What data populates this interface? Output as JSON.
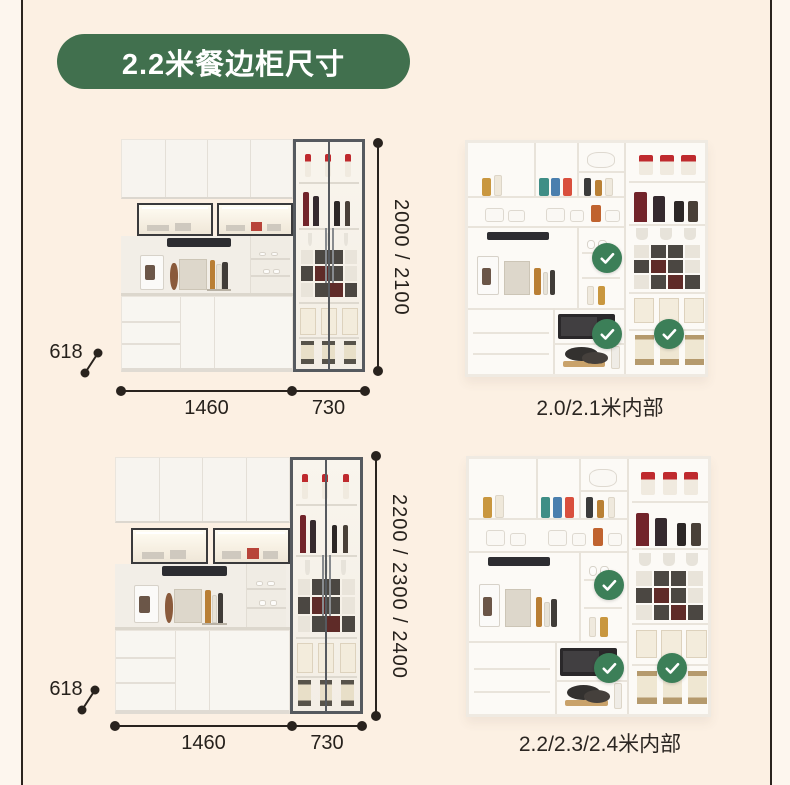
{
  "badge": {
    "label": "2.2米餐边柜尺寸"
  },
  "colors": {
    "accent_green": "#41704e",
    "check_green": "#3c7f58",
    "page_background": "#fcf0e3",
    "line_color": "#29231e"
  },
  "figures": {
    "top": {
      "height_label": "2000 / 2100",
      "depth_label": "618",
      "width_left_label": "1460",
      "width_right_label": "730"
    },
    "bottom": {
      "height_label": "2200 / 2300 / 2400",
      "depth_label": "618",
      "width_left_label": "1460",
      "width_right_label": "730"
    }
  },
  "interiors": {
    "top": {
      "caption": "2.0/2.1米内部"
    },
    "bottom": {
      "caption": "2.2/2.3/2.4米内部"
    }
  }
}
